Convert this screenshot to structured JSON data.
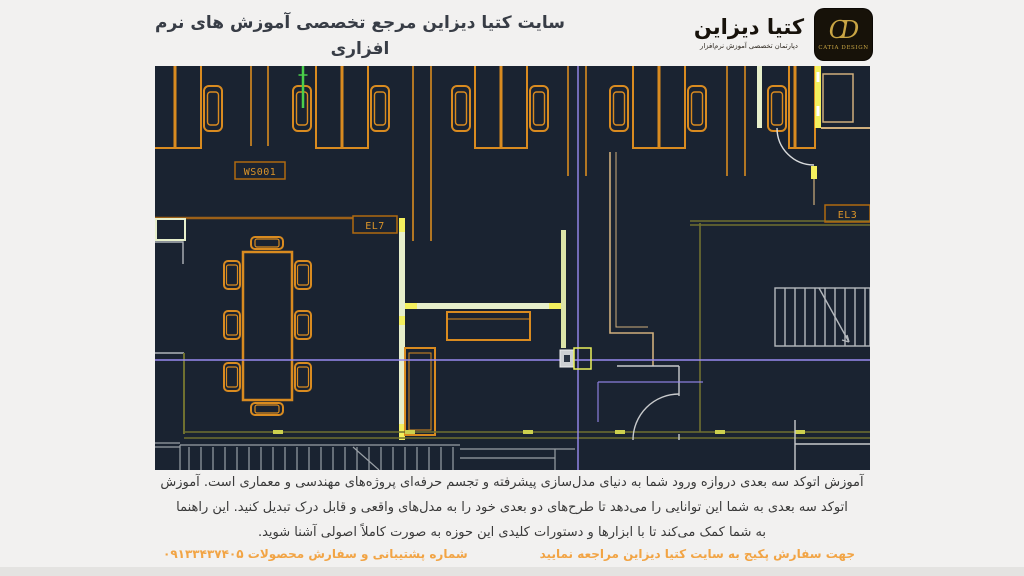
{
  "page": {
    "background": "#f2f1f0"
  },
  "header": {
    "title": "سایت کتیا دیزاین مرجع تخصصی آموزش های نرم افزاری",
    "url": "www.catiadesign.ir",
    "logo": {
      "brand": "کتیا دیزاین",
      "department": "دپارتمان تخصصی آموزش نرم‌افزار",
      "monogram": "CD",
      "brand_en": "CATIA DESIGN"
    }
  },
  "cad_view": {
    "labels": {
      "workstation": "WS001",
      "elevation7": "EL7",
      "elevation3": "EL3"
    },
    "colors": {
      "canvas": "#1a2331",
      "furniture_orange": "#d98b20",
      "highlight_yellow": "#f4f05e",
      "wall_pale_green": "#e7efcb",
      "wall_olive": "#6f7030",
      "wall_tan": "#cfae7c",
      "wall_gray": "#b4b8bd",
      "crosshair_purple": "#988af0",
      "selected_green": "#4ad04a",
      "label_orange": "#db9429"
    }
  },
  "description": {
    "line1": "آموزش اتوکد سه بعدی دروازه ورود شما به دنیای مدل‌سازی پیشرفته و تجسم حرفه‌ای پروژه‌های مهندسی و معماری است. آموزش",
    "line2": "اتوکد سه بعدی به شما این توانایی را می‌دهد تا طرح‌های دو بعدی خود را به مدل‌های واقعی و قابل درک تبدیل کنید. این راهنما",
    "line3": "به شما کمک می‌کند تا با ابزارها و دستورات کلیدی این حوزه به صورت کاملاً اصولی آشنا شوید."
  },
  "footer": {
    "order_note": "جهت سفارش پکیج به سایت کتیا دیزاین مراجعه نمایید",
    "support_note": "شماره پشتیبانی و سفارش محصولات ۰۹۱۳۳۴۳۷۴۰۵",
    "accent": "#f2a444"
  }
}
